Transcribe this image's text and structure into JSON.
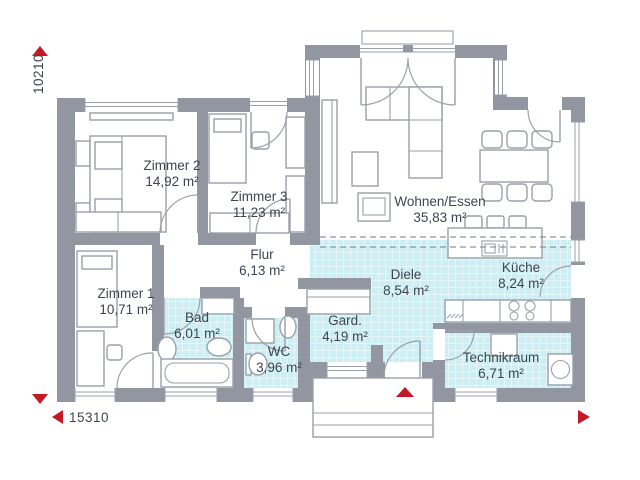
{
  "plan": {
    "dimensions": {
      "height_label": "10210",
      "width_label": "15310"
    },
    "rooms": [
      {
        "id": "zimmer2",
        "name": "Zimmer 2",
        "area": "14,92 m²"
      },
      {
        "id": "zimmer3",
        "name": "Zimmer 3",
        "area": "11,23 m²"
      },
      {
        "id": "zimmer1",
        "name": "Zimmer 1",
        "area": "10,71 m²"
      },
      {
        "id": "flur",
        "name": "Flur",
        "area": "6,13 m²"
      },
      {
        "id": "bad",
        "name": "Bad",
        "area": "6,01 m²"
      },
      {
        "id": "wc",
        "name": "WC",
        "area": "3,96 m²"
      },
      {
        "id": "garderobe",
        "name": "Gard.",
        "area": "4,19 m²"
      },
      {
        "id": "diele",
        "name": "Diele",
        "area": "8,54 m²"
      },
      {
        "id": "wohnen",
        "name": "Wohnen/Essen",
        "area": "35,83 m²"
      },
      {
        "id": "kueche",
        "name": "Küche",
        "area": "8,24 m²"
      },
      {
        "id": "technikraum",
        "name": "Technikraum",
        "area": "6,71 m²"
      }
    ],
    "colors": {
      "wall": "#9196a1",
      "tile": "#cdeef2",
      "tile_grid": "#ffffff",
      "accent_red": "#c41926",
      "line": "#9aa0a9",
      "text": "#3e4450"
    }
  }
}
